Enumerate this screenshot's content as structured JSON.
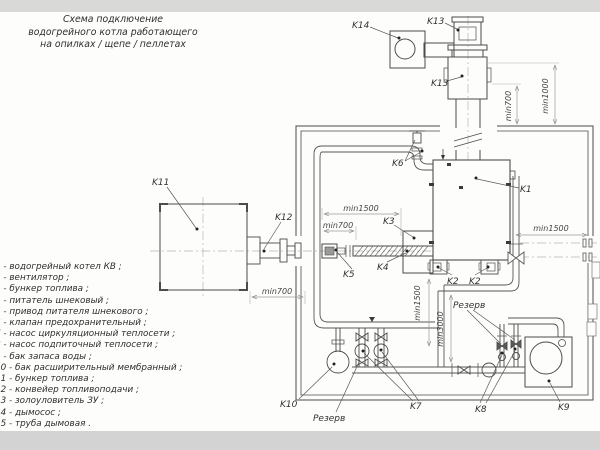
{
  "title": {
    "line1": "Схема подключение",
    "line2": "водогрейного котла работающего",
    "line3": "на опилках / щепе / пеллетах"
  },
  "legend": {
    "items": [
      "1 -  водогрейный котел КВ ;",
      "2 -  вентилятор ;",
      "3 -  бункер топлива ;",
      "4 -  питатель шнековый ;",
      "5 -  привод питателя шнекового ;",
      "6 -  клапан предохранительный ;",
      "7 -  насос циркуляционный теплосети ;",
      "8 -  насос подпиточный теплосети ;",
      "9 -  бак запаса воды ;",
      "10 -  бак расширительный мембранный ;",
      "11 -  бункер топлива ;",
      "12 -  конвейер топливоподачи ;",
      "13 -  золоуловитель ЗУ ;",
      "14 -  дымосос ;",
      "15 -  труба дымовая ."
    ]
  },
  "diagram": {
    "labels": {
      "k1": "K1",
      "k2": "K2",
      "k3": "K3",
      "k4": "K4",
      "k5": "K5",
      "k6": "K6",
      "k7": "K7",
      "k8": "K8",
      "k9": "K9",
      "k10": "K10",
      "k11": "K11",
      "k12": "K12",
      "k13": "K13",
      "k14": "K14",
      "reserve": "Резерв"
    },
    "dims": {
      "min700": "min700",
      "min1000": "min1000",
      "min1500": "min1500",
      "min3000": "min3000"
    }
  }
}
